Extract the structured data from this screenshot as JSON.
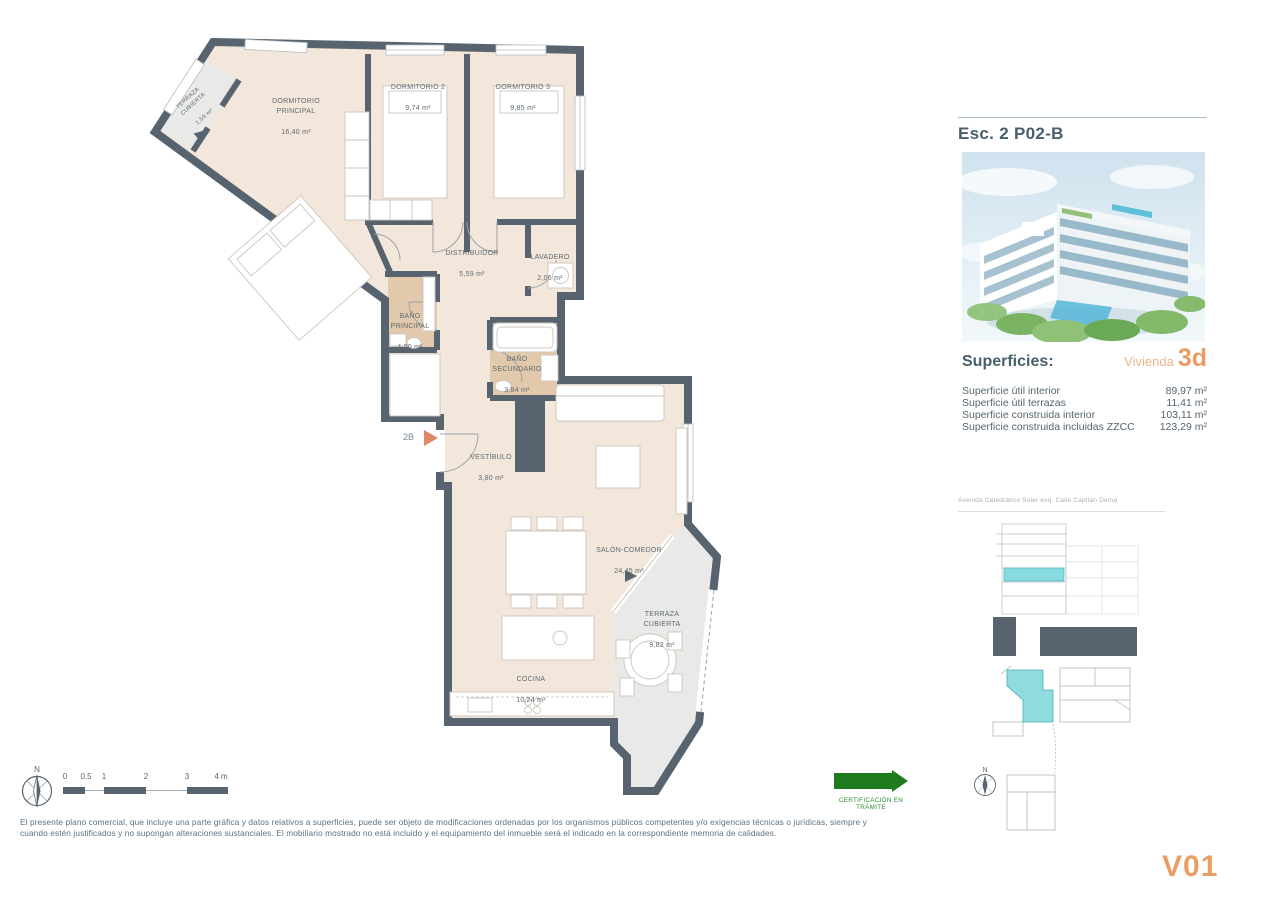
{
  "plan": {
    "rooms": [
      {
        "name": "TERRAZA\nCUBIERTA",
        "area": "1,59 m²"
      },
      {
        "name": "DORMITORIO\nPRINCIPAL",
        "area": "16,40 m²"
      },
      {
        "name": "DORMITORIO 2",
        "area": "9,74 m²"
      },
      {
        "name": "DORMITORIO 3",
        "area": "9,85 m²"
      },
      {
        "name": "DISTRIBUIDOR",
        "area": "5,59 m²"
      },
      {
        "name": "LAVADERO",
        "area": "2,06 m²"
      },
      {
        "name": "BAÑO\nPRINCIPAL",
        "area": "4,00 m²"
      },
      {
        "name": "BAÑO\nSECUNDARIO",
        "area": "3,84 m²"
      },
      {
        "name": "VESTÍBULO",
        "area": "3,80 m²"
      },
      {
        "name": "SALÓN-COMEDOR",
        "area": "24,45 m²"
      },
      {
        "name": "TERRAZA\nCUBIERTA",
        "area": "9,82 m²"
      },
      {
        "name": "COCINA",
        "area": "10,24 m²"
      }
    ],
    "entrance_label": "2B"
  },
  "side_panel": {
    "title": "Esc. 2 P02-B",
    "superficies": {
      "heading": "Superficies:",
      "unit_label": "Vivienda",
      "unit_code": "3d",
      "rows": [
        {
          "label": "Superficie útil interior",
          "value": "89,97 m²"
        },
        {
          "label": "Superficie útil terrazas",
          "value": "11,41 m²"
        },
        {
          "label": "Superficie construida interior",
          "value": "103,11 m²"
        },
        {
          "label": "Superficie construida incluidas ZZCC",
          "value": "123,29 m²"
        }
      ]
    },
    "address": "Avenida Catedrático Soler esq. Calle Capitán Dema"
  },
  "footer": {
    "compass_label": "N",
    "scale_labels": [
      "0",
      "0.5",
      "1",
      "2",
      "3",
      "4 m"
    ],
    "disclaimer": "El presente plano comercial, que incluye una parte gráfica y datos relativos a superficies, puede ser objeto de modificaciones ordenadas por los organismos públicos competentes y/o exigencias técnicas o jurídicas, siempre y\ncuando estén justificados y no supongan alteraciones sustanciales. El mobiliario mostrado no está incluido y el equipamiento del inmueble será el indicado en la correspondiente memoria de calidades.",
    "certification": "CERTIFICACIÓN EN TRÁMITE",
    "version": "V01"
  },
  "colors": {
    "wall_slate": "#57646f",
    "floor_beige": "#f3e6da",
    "bath_tan": "#e3c9ab",
    "terrace_gray": "#e9e9e7",
    "highlight_teal": "#85d9da",
    "accent_orange": "#ea9c63",
    "cert_green": "#1e7c1f"
  }
}
